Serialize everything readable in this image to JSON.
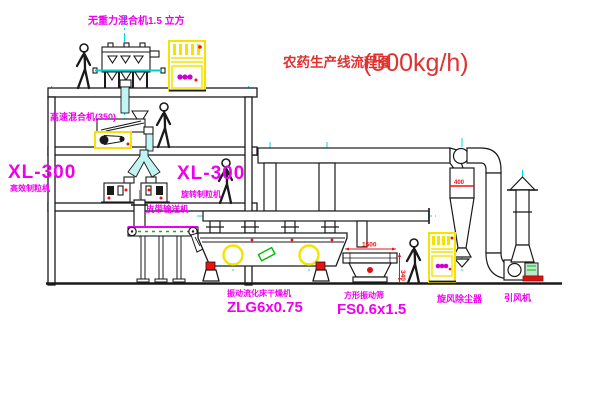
{
  "title": {
    "text": "农药生产线流程图",
    "capacity": "(500kg/h)"
  },
  "labels": {
    "gravity_free_mixer": "无重力混合机1.5 立方",
    "high_speed_mixer": "高速混合机(350)",
    "granulator_left_model": "XL-300",
    "granulator_left_name": "高效制粒机",
    "granulator_mid_model": "XL-300",
    "granulator_mid_name": "旋转制粒机",
    "belt_conveyor": "皮带输送机",
    "fluid_bed_dryer_name": "振动流化床干燥机",
    "fluid_bed_dryer_model": "ZLG6x0.75",
    "vibrating_screen_name": "方形振动筛",
    "vibrating_screen_model": "FS0.6x1.5",
    "cyclone": "旋风除尘器",
    "fan": "引风机"
  },
  "dimensions": {
    "screen_length": "1500",
    "screen_height": "340",
    "cyclone_flange": "400"
  },
  "colors": {
    "label_magenta": "#ee00ee",
    "title_red": "#e03131",
    "centerline_cyan": "#00dcdc",
    "machine_yellow": "#f2e400",
    "accent_red": "#ee1111",
    "accent_green": "#00bb00",
    "line_black": "#1a1a1a"
  }
}
